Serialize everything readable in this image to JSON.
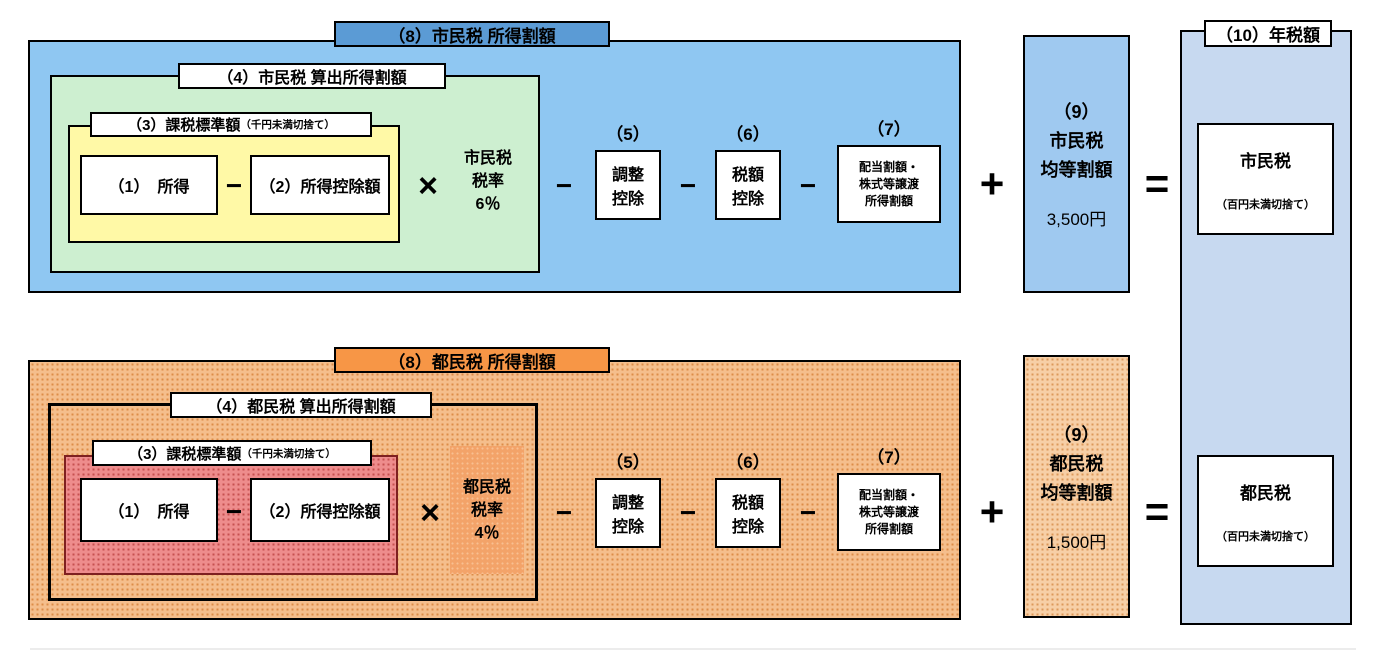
{
  "colors": {
    "city_section_bg": "#8FC7F2",
    "city_title_bg": "#5B9BD5",
    "city_calc_bg": "#CDEFD0",
    "city_base_bg": "#FFF9A6",
    "city_percapita_bg": "#9FC9F0",
    "annual_panel_bg": "#C7D9F0",
    "metro_section_bg": "#F5BE8C",
    "metro_section_dot": "#DD8C48",
    "metro_title_bg": "#F79646",
    "metro_base_bg": "#EE8C8C",
    "metro_base_dot": "#C65050",
    "metro_rate_bg": "#F3A369",
    "metro_percapita_bg": "#F7CFA6",
    "box_border": "#000000"
  },
  "ops": {
    "minus": "−",
    "times": "×",
    "plus": "+",
    "equals": "="
  },
  "city": {
    "section_title": "（8）市民税 所得割額",
    "calc_title": "（4）市民税 算出所得割額",
    "base_title": "（3）課税標準額",
    "base_note": "（千円未満切捨て）",
    "income_label": "（1）　所得",
    "deduction_label": "（2）所得控除額",
    "rate": {
      "line1": "市民税",
      "line2": "税率",
      "line3": "6％"
    },
    "adjust": {
      "num": "（5）",
      "line1": "調整",
      "line2": "控除"
    },
    "credit": {
      "num": "（6）",
      "line1": "税額",
      "line2": "控除"
    },
    "dividend": {
      "num": "（7）",
      "line1": "配当割額・",
      "line2": "株式等譲渡",
      "line3": "所得割額"
    },
    "percapita": {
      "num": "（9）",
      "line1": "市民税",
      "line2": "均等割額",
      "amount": "3,500円"
    }
  },
  "metro": {
    "section_title": "（8）都民税 所得割額",
    "calc_title": "（4）都民税 算出所得割額",
    "base_title": "（3）課税標準額",
    "base_note": "（千円未満切捨て）",
    "income_label": "（1）　所得",
    "deduction_label": "（2）所得控除額",
    "rate": {
      "line1": "都民税",
      "line2": "税率",
      "line3": "4％"
    },
    "adjust": {
      "num": "（5）",
      "line1": "調整",
      "line2": "控除"
    },
    "credit": {
      "num": "（6）",
      "line1": "税額",
      "line2": "控除"
    },
    "dividend": {
      "num": "（7）",
      "line1": "配当割額・",
      "line2": "株式等譲渡",
      "line3": "所得割額"
    },
    "percapita": {
      "num": "（9）",
      "line1": "都民税",
      "line2": "均等割額",
      "amount": "1,500円"
    }
  },
  "annual": {
    "title": "（10）年税額",
    "city": {
      "label": "市民税",
      "note": "（百円未満切捨て）"
    },
    "metro": {
      "label": "都民税",
      "note": "（百円未満切捨て）"
    }
  }
}
